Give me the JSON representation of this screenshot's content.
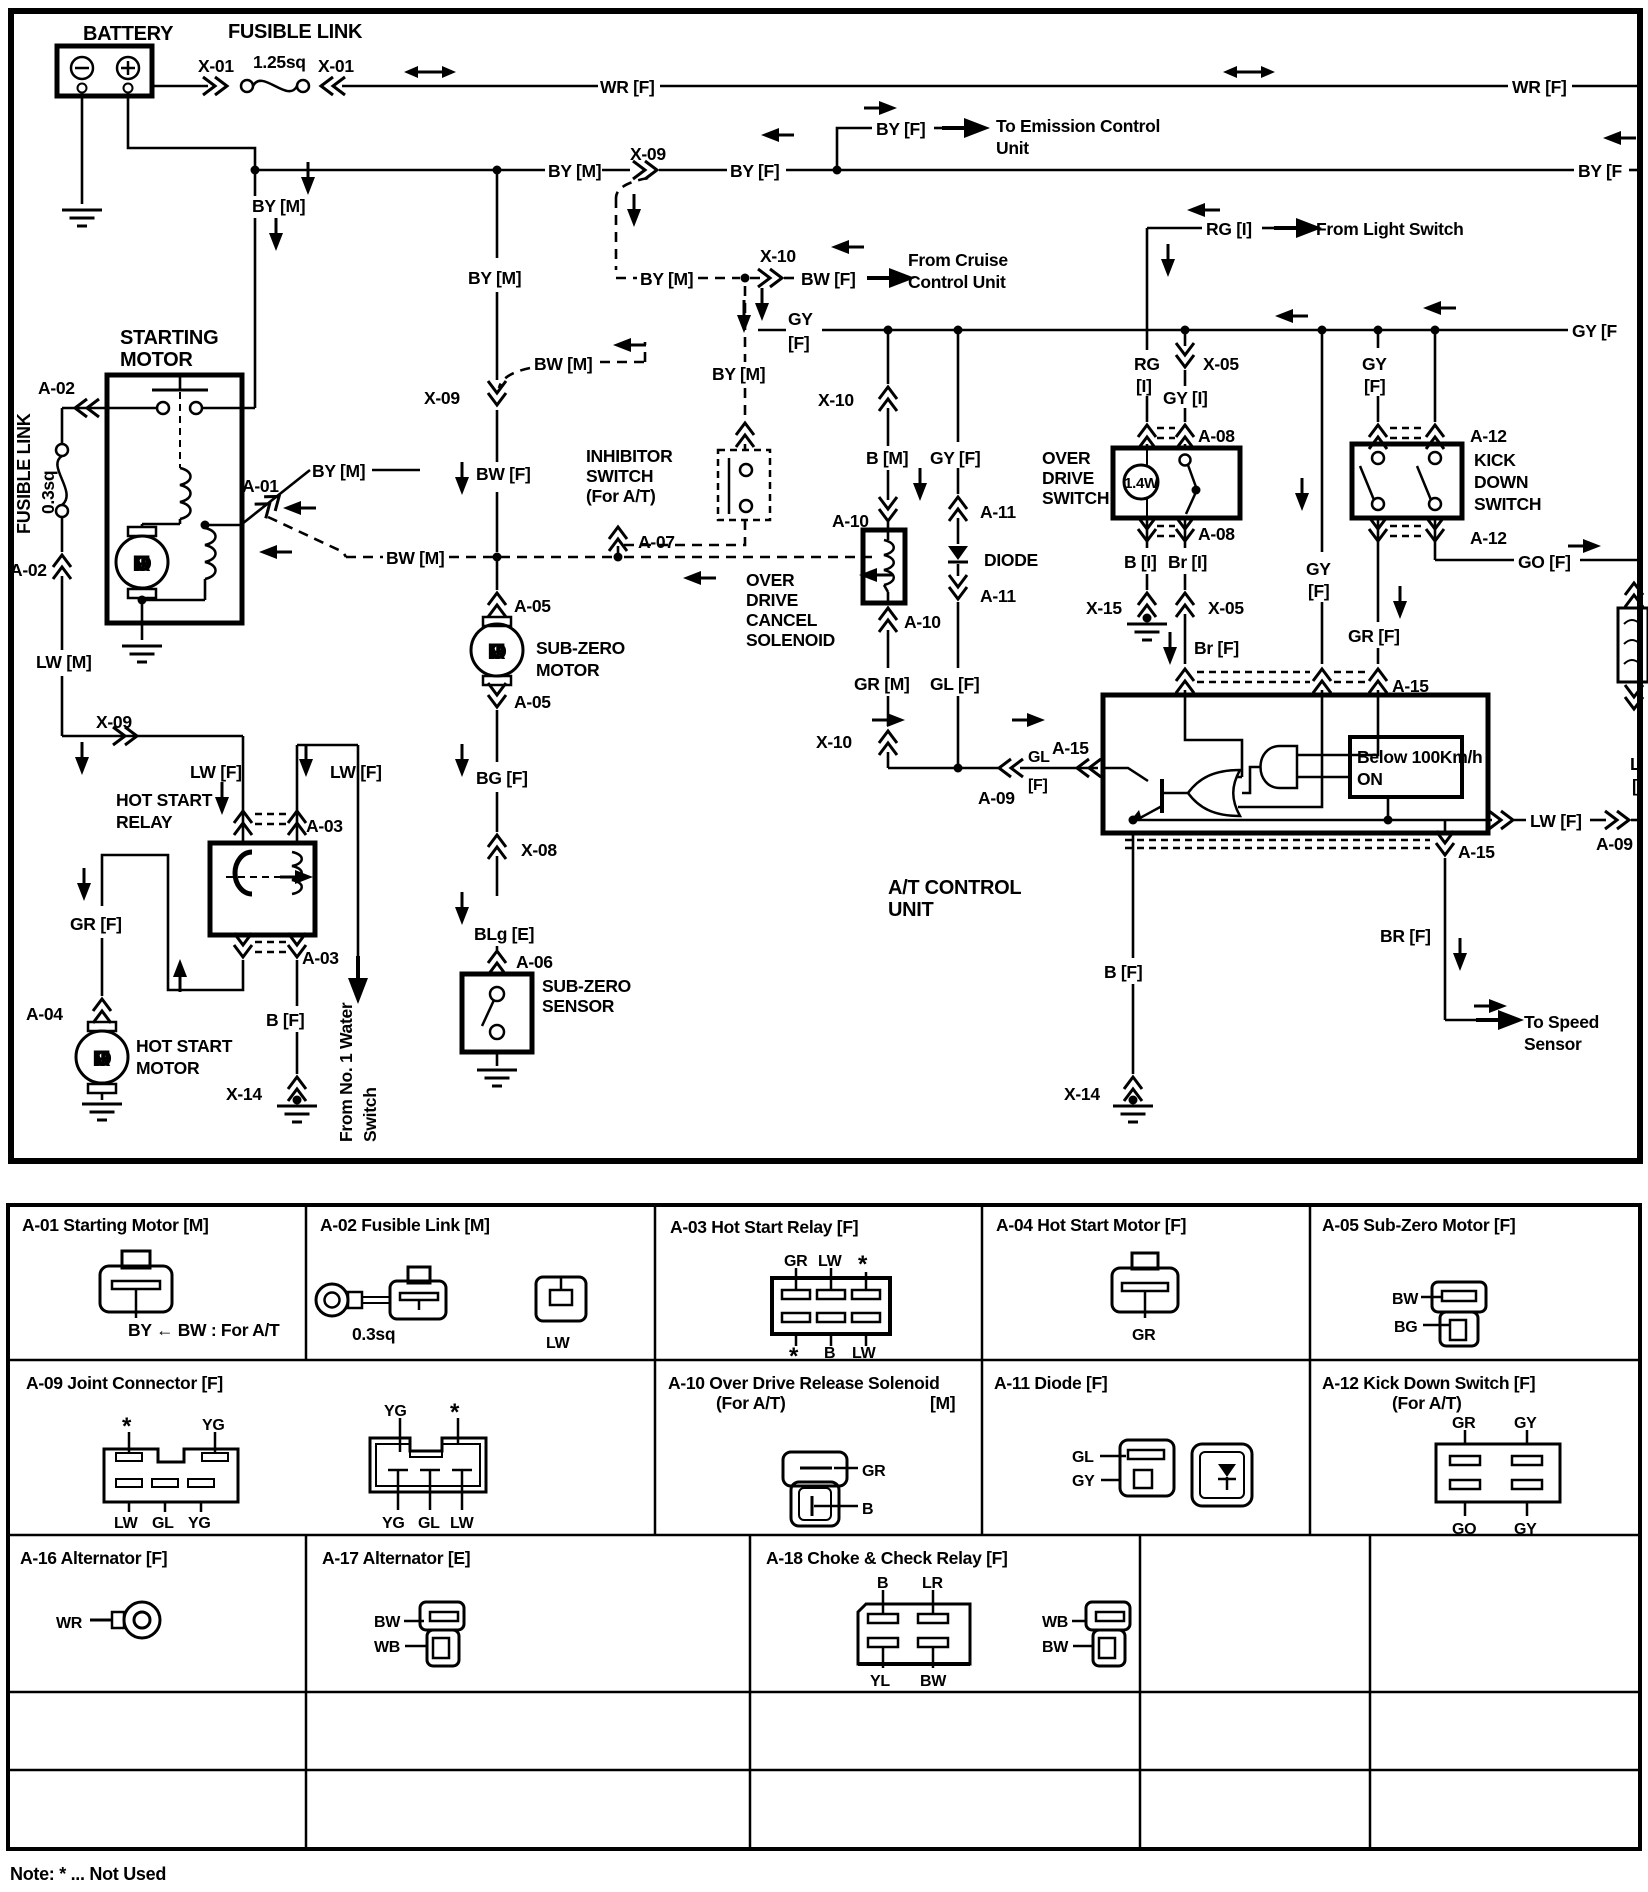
{
  "colors": {
    "ink": "#000000",
    "paper": "#ffffff"
  },
  "t": {
    "battery": "BATTERY",
    "fus_link": "FUSIBLE LINK",
    "x01": "X-01",
    "sq125": "1.25sq",
    "wr_f": "WR [F]",
    "by_m": "BY [M]",
    "by_f": "BY [F]",
    "by_f_cut": "BY [F",
    "x09": "X-09",
    "to_em": "To Emission Control",
    "unit_c": "Unit",
    "x10": "X-10",
    "bw_f": "BW [F]",
    "bw_m": "BW [M]",
    "from_cr": "From Cruise",
    "ctrl_unit": "Control Unit",
    "rg_i": "RG [I]",
    "from_light": "From Light Switch",
    "gy": "GY",
    "fb": "[F]",
    "ib": "[I]",
    "gy_f": "GY [F]",
    "gy_f_cut": "GY [F",
    "starting": "STARTING",
    "motor": "MOTOR",
    "a01": "A-01",
    "a02": "A-02",
    "sq03": "0.3sq",
    "lw_m": "LW [M]",
    "inhibitor": "INHIBITOR",
    "switch_u": "SWITCH",
    "for_at": "(For A/T)",
    "a07": "A-07",
    "a05": "A-05",
    "sub_zero": "SUB-ZERO",
    "bg_f": "BG [F]",
    "x08": "X-08",
    "blg_e": "BLg [E]",
    "a06": "A-06",
    "sensor_u": "SENSOR",
    "lw_f": "LW [F]",
    "hot_start": "HOT START",
    "relay": "RELAY",
    "a03": "A-03",
    "gr_f": "GR [F]",
    "a04": "A-04",
    "b_f": "B [F]",
    "x14": "X-14",
    "water1": "From No. 1 Water",
    "water2": "Switch",
    "over": "OVER",
    "drive": "DRIVE",
    "cancel": "CANCEL",
    "solenoid": "SOLENOID",
    "b_m": "B [M]",
    "a10": "A-10",
    "gr_m": "GR [M]",
    "gl": "GL",
    "gl_f": "GL [F]",
    "a11": "A-11",
    "diode": "DIODE",
    "a09": "A-09",
    "a15": "A-15",
    "w14": "1.4W",
    "rg": "RG",
    "x05": "X-05",
    "gy_i": "GY [I]",
    "a08": "A-08",
    "b_i": "B [I]",
    "br_i": "Br [I]",
    "x15": "X-15",
    "br_fl": "Br [F]",
    "kick": "KICK",
    "down": "DOWN",
    "a12": "A-12",
    "go_f": "GO [F]",
    "below": "Below 100Km/h",
    "on": "ON",
    "at_ctrl": "A/T CONTROL",
    "unit_uu": "UNIT",
    "br_fu": "BR [F]",
    "to_speed": "To Speed",
    "sensor_c": "Sensor",
    "lw": "LW",
    "edge_l": "L",
    "edge_b": "[",
    "star": "*"
  },
  "tb": {
    "a01": {
      "title": "A-01 Starting Motor [M]",
      "cap": "BY ← BW : For A/T"
    },
    "a02": {
      "title": "A-02 Fusible Link [M]",
      "sq": "0.3sq",
      "pin": "LW"
    },
    "a03": {
      "title": "A-03 Hot Start Relay [F]",
      "top": [
        "GR",
        "LW",
        "*"
      ],
      "bottom": [
        "*",
        "B",
        "LW"
      ]
    },
    "a04": {
      "title": "A-04 Hot Start Motor [F]",
      "pin": "GR"
    },
    "a05": {
      "title": "A-05 Sub-Zero Motor [F]",
      "pins": [
        "BW",
        "BG"
      ]
    },
    "a09": {
      "title": "A-09 Joint Connector [F]",
      "l_top": [
        "*",
        "YG"
      ],
      "l_bottom": [
        "LW",
        "GL",
        "YG"
      ],
      "r_top": [
        "YG",
        "*"
      ],
      "r_bottom": [
        "YG",
        "GL",
        "LW"
      ]
    },
    "a10": {
      "title": "A-10 Over Drive Release Solenoid",
      "sub": "(For A/T)",
      "loc": "[M]",
      "pins": [
        "GR",
        "B"
      ]
    },
    "a11": {
      "title": "A-11 Diode [F]",
      "pins": [
        "GL",
        "GY"
      ]
    },
    "a12": {
      "title": "A-12 Kick Down Switch [F]",
      "sub": "(For A/T)",
      "top": [
        "GR",
        "GY"
      ],
      "bottom": [
        "GO",
        "GY"
      ]
    },
    "a16": {
      "title": "A-16 Alternator [F]",
      "pin": "WR"
    },
    "a17": {
      "title": "A-17 Alternator [E]",
      "pins": [
        "BW",
        "WB"
      ]
    },
    "a18": {
      "title": "A-18 Choke & Check Relay [F]",
      "top": [
        "B",
        "LR"
      ],
      "bottom": [
        "YL",
        "BW"
      ],
      "right_pins": [
        "WB",
        "BW"
      ]
    }
  },
  "note": "Note: * ... Not Used"
}
